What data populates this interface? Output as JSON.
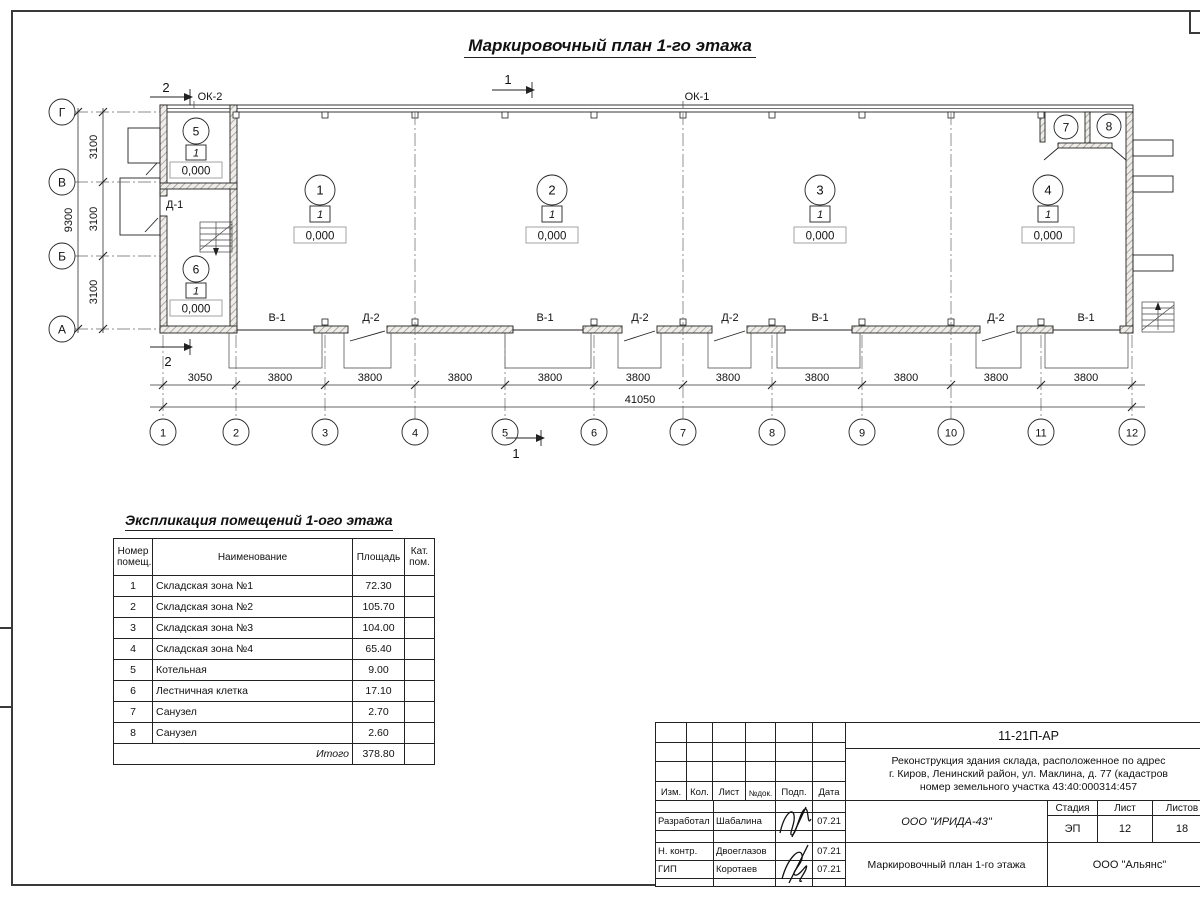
{
  "sheet": {
    "plan_title": "Маркировочный план 1-го этажа"
  },
  "plan": {
    "axes_rows": [
      "Г",
      "В",
      "Б",
      "А"
    ],
    "axes_cols": [
      "1",
      "2",
      "3",
      "4",
      "5",
      "6",
      "7",
      "8",
      "9",
      "10",
      "11",
      "12"
    ],
    "dims_left": [
      "3100",
      "3100",
      "3100"
    ],
    "dims_left_total": "9300",
    "dims_bottom": [
      "3050",
      "3800",
      "3800",
      "3800",
      "3800",
      "3800",
      "3800",
      "3800",
      "3800",
      "3800",
      "3800"
    ],
    "dims_bottom_total": "41050",
    "section_1": "1",
    "section_2": "2",
    "labels": {
      "ok1": "ОК-1",
      "ok2": "ОК-2",
      "d1": "Д-1"
    },
    "bottom_openings": [
      "В-1",
      "Д-2",
      "В-1",
      "Д-2",
      "Д-2",
      "В-1",
      "Д-2",
      "В-1"
    ],
    "room_marks": [
      {
        "num": "1",
        "cat": "1",
        "level": "0,000"
      },
      {
        "num": "2",
        "cat": "1",
        "level": "0,000"
      },
      {
        "num": "3",
        "cat": "1",
        "level": "0,000"
      },
      {
        "num": "4",
        "cat": "1",
        "level": "0,000"
      },
      {
        "num": "5",
        "cat": "1",
        "level": "0,000"
      },
      {
        "num": "6",
        "cat": "1",
        "level": "0,000"
      },
      {
        "num": "7"
      },
      {
        "num": "8"
      }
    ]
  },
  "schedule": {
    "title": "Экспликация помещений 1-ого этажа",
    "headers": {
      "num1": "Номер",
      "num2": "помещ.",
      "name": "Наименование",
      "area": "Площадь",
      "cat1": "Кат.",
      "cat2": "пом."
    },
    "rows": [
      {
        "num": "1",
        "name": "Складская зона №1",
        "area": "72.30"
      },
      {
        "num": "2",
        "name": "Складская зона №2",
        "area": "105.70"
      },
      {
        "num": "3",
        "name": "Складская зона №3",
        "area": "104.00"
      },
      {
        "num": "4",
        "name": "Складская зона №4",
        "area": "65.40"
      },
      {
        "num": "5",
        "name": "Котельная",
        "area": "9.00"
      },
      {
        "num": "6",
        "name": "Лестничная клетка",
        "area": "17.10"
      },
      {
        "num": "7",
        "name": "Санузел",
        "area": "2.70"
      },
      {
        "num": "8",
        "name": "Санузел",
        "area": "2.60"
      }
    ],
    "total_label": "Итого",
    "total_value": "378.80"
  },
  "titleblock": {
    "doc_code": "11-21П-АР",
    "project": [
      "Реконструкция здания склада, расположенное по адрес",
      "г. Киров, Ленинский район, ул. Маклина, д. 77 (кадастров",
      "номер земельного участка 43:40:000314:457"
    ],
    "revision_headers": [
      "Изм.",
      "Кол.",
      "Лист",
      "№док.",
      "Подп.",
      "Дата"
    ],
    "roles": [
      {
        "role": "Разработал",
        "name": "Шабалина",
        "date": "07.21"
      },
      {
        "role": "Н. контр.",
        "name": "Двоеглазов",
        "date": "07.21"
      },
      {
        "role": "ГИП",
        "name": "Коротаев",
        "date": "07.21"
      }
    ],
    "designer_org": "ООО \"ИРИДА-43\"",
    "stage_header": "Стадия",
    "sheet_header": "Лист",
    "sheets_header": "Листов",
    "stage": "ЭП",
    "sheet_no": "12",
    "sheets_total": "18",
    "drawing_title": "Маркировочный план 1-го этажа",
    "client_org": "ООО \"Альянс\""
  }
}
